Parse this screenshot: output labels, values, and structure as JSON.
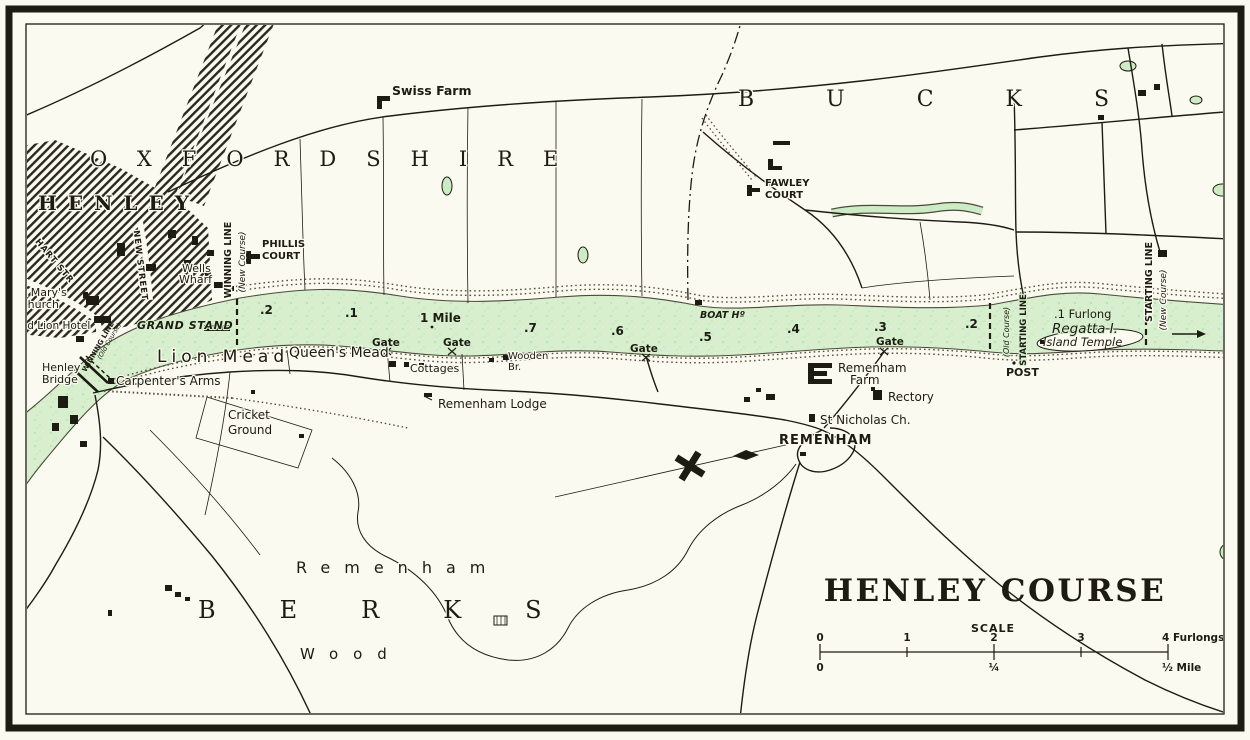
{
  "title": "HENLEY COURSE",
  "colors": {
    "paper": "#fbfaf0",
    "ink": "#1d1c12",
    "river_green": "#d7efce"
  },
  "scale": {
    "caption": "SCALE",
    "furlongs": [
      "0",
      "1",
      "2",
      "3"
    ],
    "furlongs_end": "4 Furlongs",
    "miles": [
      "0",
      "¼"
    ],
    "miles_end": "½ Mile"
  },
  "labels": {
    "counties": {
      "oxfordshire": "OXFORDSHIRE",
      "bucks": "BUCKS",
      "berks": "BERKS"
    },
    "settlements": {
      "henley": "HENLEY",
      "remenham": "REMENHAM"
    },
    "district": {
      "remenham_wood_1": "Remenham",
      "remenham_wood_2": "Wood"
    },
    "streets": {
      "hart_st": "HART STR",
      "new_street": "NEW STREET"
    },
    "meads": {
      "lion_mead": "Lion Mead",
      "queens_mead": "Queen's Mead"
    },
    "places": {
      "swiss_farm": "Swiss Farm",
      "fawley_court_1": "FAWLEY",
      "fawley_court_2": "COURT",
      "phillis_court_1": "PHILLIS",
      "phillis_court_2": "COURT",
      "wells_wharf_1": "Wells",
      "wells_wharf_2": "Wharf",
      "st_marys_1": "St Mary's",
      "st_marys_2": "Church",
      "red_lion": "Red Lion Hotel",
      "henley_bridge_1": "Henley",
      "henley_bridge_2": "Bridge",
      "carpenters_arms": "Carpenter's Arms",
      "grand_stand": "GRAND STAND",
      "cottages": "Cottages",
      "wooden_br_1": "Wooden",
      "wooden_br_2": "Br.",
      "remenham_lodge": "Remenham Lodge",
      "cricket_ground_1": "Cricket",
      "cricket_ground_2": "Ground",
      "remenham_farm_1": "Remenham",
      "remenham_farm_2": "Farm",
      "rectory": "Rectory",
      "st_nicholas": "St Nicholas Ch.",
      "boat_house": "BOAT Hº"
    },
    "river": {
      "markers": [
        ".2",
        ".1",
        "1 Mile",
        ".7",
        ".6",
        ".5",
        ".4",
        ".3",
        ".2"
      ],
      "furlong": ".1 Furlong",
      "regatta_island": "Regatta I.",
      "island_temple": "Island Temple",
      "gate": "Gate",
      "post": "POST"
    },
    "course": {
      "winning_line": "WINNING LINE",
      "starting_line": "STARTING LINE",
      "new_course": "(New Course)",
      "old_course": "(Old Course)"
    }
  }
}
